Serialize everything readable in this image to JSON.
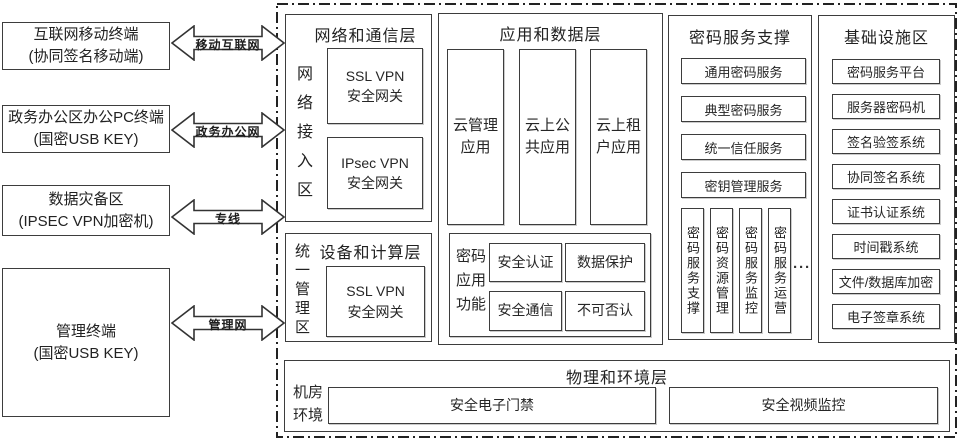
{
  "left_terminals": [
    {
      "label": "互联网移动终端\n(协同签名移动端)"
    },
    {
      "label": "政务办公区办公PC终端\n(国密USB KEY)"
    },
    {
      "label": "数据灾备区\n(IPSEC VPN加密机)"
    },
    {
      "label": "管理终端\n(国密USB KEY)"
    }
  ],
  "network_links": [
    {
      "label": "移动互联网"
    },
    {
      "label": "政务办公网"
    },
    {
      "label": "专线"
    },
    {
      "label": "管理网"
    }
  ],
  "platform": {
    "network_layer": {
      "title": "网络和通信层",
      "zone": "网络接入区",
      "gateways": [
        "SSL VPN\n安全网关",
        "IPsec VPN\n安全网关"
      ]
    },
    "device_layer": {
      "title": "设备和计算层",
      "zone": "统一管理区",
      "gateways": [
        "SSL VPN\n安全网关"
      ]
    },
    "app_layer": {
      "title": "应用和数据层",
      "apps": [
        "云管理\n应用",
        "云上公\n共应用",
        "云上租\n户应用"
      ],
      "crypto_functions": {
        "label": "密码\n应用\n功能",
        "items": [
          "安全认证",
          "数据保护",
          "安全通信",
          "不可否认"
        ]
      }
    },
    "service_layer": {
      "title": "密码服务支撑",
      "services": [
        "通用密码服务",
        "典型密码服务",
        "统一信任服务",
        "密钥管理服务"
      ],
      "operations": [
        "密码服务支撑",
        "密码资源管理",
        "密码服务监控",
        "密码服务运营"
      ],
      "more": "···"
    },
    "infra_layer": {
      "title": "基础设施区",
      "systems": [
        "密码服务平台",
        "服务器密码机",
        "签名验签系统",
        "协同签名系统",
        "证书认证系统",
        "时间戳系统",
        "文件/数据库加密",
        "电子签章系统"
      ]
    },
    "physical_layer": {
      "title": "物理和环境层",
      "zone": "机房\n环境",
      "items": [
        "安全电子门禁",
        "安全视频监控"
      ]
    }
  }
}
